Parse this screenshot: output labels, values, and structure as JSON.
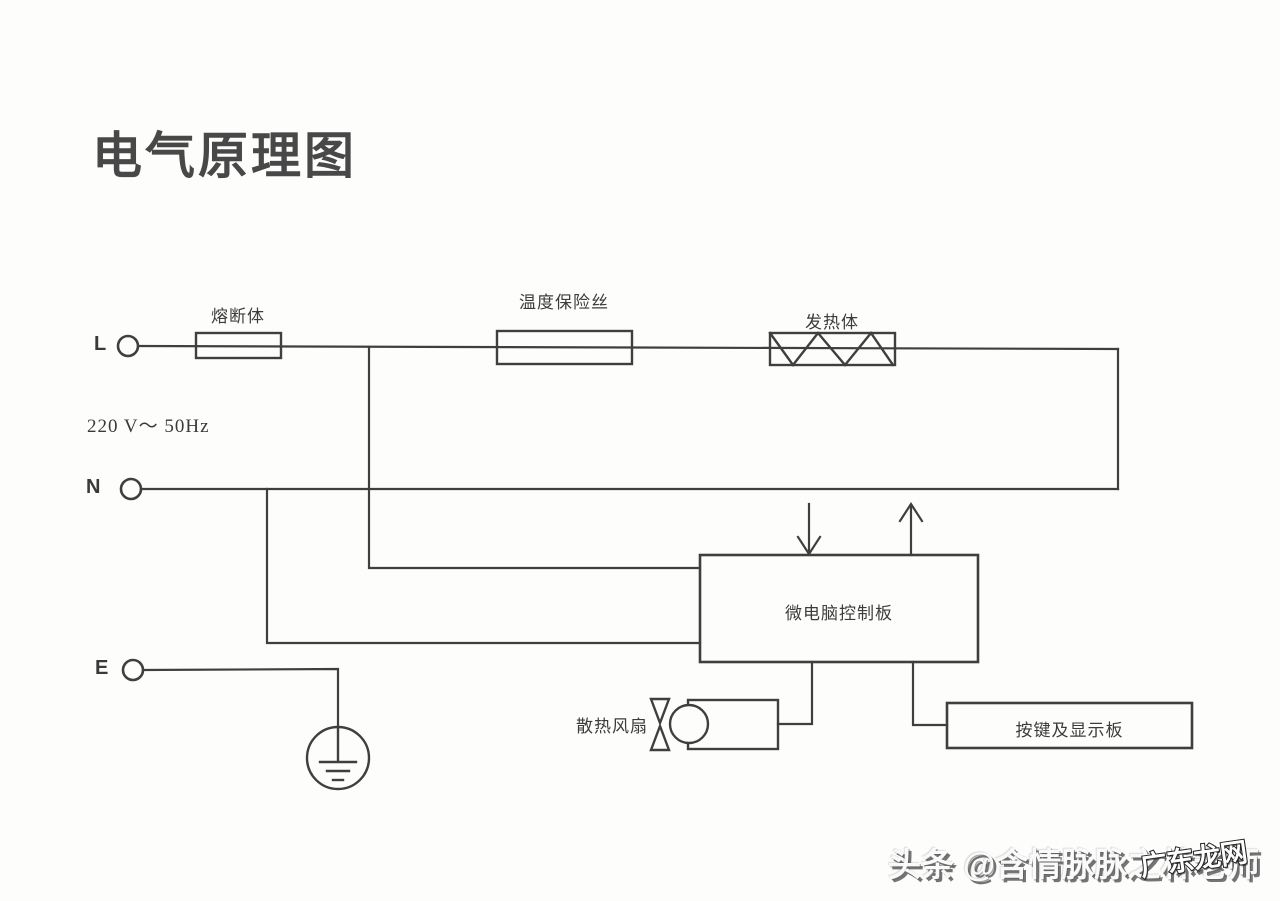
{
  "title": "电气原理图",
  "power": {
    "rating": "220 V～ 50Hz"
  },
  "terminals": {
    "live": "L",
    "neutral": "N",
    "earth": "E"
  },
  "components": {
    "fuse": "熔断体",
    "thermal_fuse": "温度保险丝",
    "heater": "发热体",
    "control_board": "微电脑控制板",
    "fan": "散热风扇",
    "display_board": "按键及显示板"
  },
  "watermarks": {
    "main": "头条 @含情脉脉之林老师",
    "corner": "广东龙网"
  },
  "colors": {
    "line": "#3f3f3f",
    "background": "#fdfdfc",
    "text": "#3c3c3c"
  }
}
